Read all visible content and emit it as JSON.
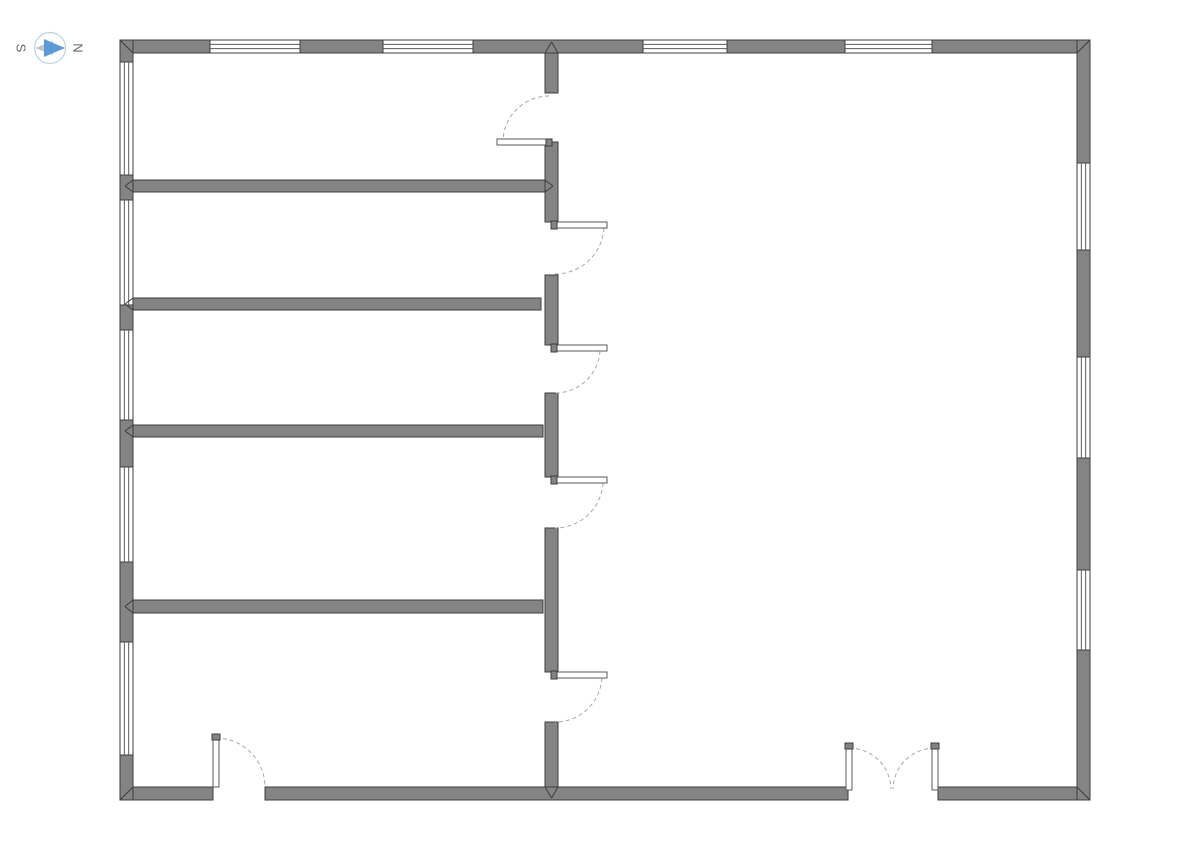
{
  "compass": {
    "south_label": "S",
    "north_label": "N",
    "circle_color": "#bcd4e6",
    "arrow_secondary_color": "#c2c6ca",
    "arrow_primary_color": "#5b9bd5",
    "label_color": "#666666"
  },
  "canvas": {
    "width": 1190,
    "height": 842,
    "background": "#ffffff"
  },
  "style": {
    "wall_fill": "#848484",
    "wall_stroke": "#3d3d3d",
    "window_fill": "#ffffff",
    "window_line_color": "#5a5a5a",
    "door_leaf_fill": "#ffffff",
    "door_leaf_stroke": "#5a5a5a",
    "door_arc_color": "#a8a8a8"
  },
  "walls": [
    {
      "name": "top-wall-segment",
      "x": 120,
      "y": 40,
      "w": 90,
      "h": 13
    },
    {
      "name": "top-wall-segment",
      "x": 300,
      "y": 40,
      "w": 83,
      "h": 13
    },
    {
      "name": "top-wall-segment",
      "x": 473,
      "y": 40,
      "w": 170,
      "h": 13
    },
    {
      "name": "top-wall-segment",
      "x": 727,
      "y": 40,
      "w": 118,
      "h": 13
    },
    {
      "name": "top-wall-segment",
      "x": 932,
      "y": 40,
      "w": 158,
      "h": 13
    },
    {
      "name": "bottom-wall-segment",
      "x": 120,
      "y": 787,
      "w": 93,
      "h": 13
    },
    {
      "name": "bottom-wall-segment",
      "x": 265,
      "y": 787,
      "w": 583,
      "h": 13
    },
    {
      "name": "bottom-wall-segment",
      "x": 938,
      "y": 787,
      "w": 152,
      "h": 13
    },
    {
      "name": "left-wall-segment",
      "x": 120,
      "y": 40,
      "w": 13,
      "h": 22
    },
    {
      "name": "left-wall-segment",
      "x": 120,
      "y": 175,
      "w": 13,
      "h": 25
    },
    {
      "name": "left-wall-segment",
      "x": 120,
      "y": 305,
      "w": 13,
      "h": 25
    },
    {
      "name": "left-wall-segment",
      "x": 120,
      "y": 420,
      "w": 13,
      "h": 47
    },
    {
      "name": "left-wall-segment",
      "x": 120,
      "y": 562,
      "w": 13,
      "h": 80
    },
    {
      "name": "left-wall-segment",
      "x": 120,
      "y": 755,
      "w": 13,
      "h": 45
    },
    {
      "name": "right-wall-segment",
      "x": 1077,
      "y": 40,
      "w": 13,
      "h": 123
    },
    {
      "name": "right-wall-segment",
      "x": 1077,
      "y": 250,
      "w": 13,
      "h": 107
    },
    {
      "name": "right-wall-segment",
      "x": 1077,
      "y": 458,
      "w": 13,
      "h": 112
    },
    {
      "name": "right-wall-segment",
      "x": 1077,
      "y": 650,
      "w": 13,
      "h": 150
    },
    {
      "name": "middle-wall-segment",
      "x": 545,
      "y": 53,
      "w": 13,
      "h": 40
    },
    {
      "name": "middle-wall-segment",
      "x": 545,
      "y": 142,
      "w": 13,
      "h": 80
    },
    {
      "name": "middle-wall-segment",
      "x": 545,
      "y": 275,
      "w": 13,
      "h": 70
    },
    {
      "name": "middle-wall-segment",
      "x": 545,
      "y": 393,
      "w": 13,
      "h": 84
    },
    {
      "name": "middle-wall-segment",
      "x": 545,
      "y": 528,
      "w": 13,
      "h": 144
    },
    {
      "name": "middle-wall-segment",
      "x": 545,
      "y": 722,
      "w": 13,
      "h": 65
    },
    {
      "name": "interior-wall-1",
      "x": 133,
      "y": 180,
      "w": 412,
      "h": 12
    },
    {
      "name": "interior-wall-2",
      "x": 133,
      "y": 298,
      "w": 408,
      "h": 12
    },
    {
      "name": "interior-wall-3",
      "x": 133,
      "y": 425,
      "w": 410,
      "h": 12
    },
    {
      "name": "interior-wall-4",
      "x": 133,
      "y": 600,
      "w": 410,
      "h": 13
    }
  ],
  "windows": [
    {
      "name": "window-top-1",
      "x": 210,
      "y": 40,
      "w": 90,
      "h": 13,
      "o": "h"
    },
    {
      "name": "window-top-2",
      "x": 383,
      "y": 40,
      "w": 90,
      "h": 13,
      "o": "h"
    },
    {
      "name": "window-top-3",
      "x": 643,
      "y": 40,
      "w": 84,
      "h": 13,
      "o": "h"
    },
    {
      "name": "window-top-4",
      "x": 845,
      "y": 40,
      "w": 87,
      "h": 13,
      "o": "h"
    },
    {
      "name": "window-left-1",
      "x": 120,
      "y": 62,
      "w": 13,
      "h": 113,
      "o": "v"
    },
    {
      "name": "window-left-2",
      "x": 120,
      "y": 200,
      "w": 13,
      "h": 105,
      "o": "v"
    },
    {
      "name": "window-left-3",
      "x": 120,
      "y": 330,
      "w": 13,
      "h": 90,
      "o": "v"
    },
    {
      "name": "window-left-4",
      "x": 120,
      "y": 467,
      "w": 13,
      "h": 95,
      "o": "v"
    },
    {
      "name": "window-left-5",
      "x": 120,
      "y": 642,
      "w": 13,
      "h": 113,
      "o": "v"
    },
    {
      "name": "window-right-1",
      "x": 1077,
      "y": 163,
      "w": 13,
      "h": 87,
      "o": "v"
    },
    {
      "name": "window-right-2",
      "x": 1077,
      "y": 357,
      "w": 13,
      "h": 101,
      "o": "v"
    },
    {
      "name": "window-right-3",
      "x": 1077,
      "y": 570,
      "w": 13,
      "h": 80,
      "o": "v"
    }
  ],
  "doors": [
    {
      "name": "door-room1",
      "leaf": [
        497,
        139,
        55,
        6
      ],
      "cap": [
        546,
        139,
        6,
        7
      ],
      "arc": "M549,96 A46,46 0 0 0 503,142"
    },
    {
      "name": "door-room2",
      "leaf": [
        552,
        222,
        55,
        6
      ],
      "cap": [
        551,
        221,
        6,
        8
      ],
      "arc": "M604,228 A49,49 0 0 1 555,274"
    },
    {
      "name": "door-room3",
      "leaf": [
        552,
        345,
        55,
        6
      ],
      "cap": [
        551,
        344,
        6,
        8
      ],
      "arc": "M600,351 A45,45 0 0 1 555,393"
    },
    {
      "name": "door-room4",
      "leaf": [
        552,
        477,
        55,
        6
      ],
      "cap": [
        551,
        476,
        6,
        8
      ],
      "arc": "M603,483 A48,48 0 0 1 555,528"
    },
    {
      "name": "door-room5",
      "leaf": [
        552,
        672,
        55,
        6
      ],
      "cap": [
        551,
        671,
        6,
        8
      ],
      "arc": "M602,678 A47,47 0 0 1 555,722"
    },
    {
      "name": "door-exterior-left",
      "leaf": [
        213,
        735,
        6,
        52
      ],
      "cap": [
        212,
        734,
        8,
        6
      ],
      "arc": "M216,738 A49,49 0 0 1 265,787"
    },
    {
      "name": "double-door-left-leaf",
      "leaf": [
        846,
        745,
        6,
        45
      ],
      "cap": [
        845,
        743,
        8,
        6
      ],
      "arc": "M849,748 A42,42 0 0 1 891,789"
    },
    {
      "name": "double-door-right-leaf",
      "leaf": [
        932,
        745,
        6,
        45
      ],
      "cap": [
        931,
        743,
        8,
        6
      ],
      "arc": "M935,748 A42,42 0 0 0 893,789"
    }
  ],
  "miters": [
    {
      "name": "miter-corner-top-left",
      "d": "M120,40 L133,53"
    },
    {
      "name": "miter-corner-top-right",
      "d": "M1090,40 L1077,53"
    },
    {
      "name": "miter-corner-bottom-left",
      "d": "M120,800 L133,787"
    },
    {
      "name": "miter-corner-bottom-right",
      "d": "M1090,800 L1077,787"
    },
    {
      "name": "miter-top-middle-junction",
      "d": "M545,53 L551.5,42 M558,53 L551.5,42"
    },
    {
      "name": "miter-bottom-middle-junction",
      "d": "M545,787 L551.5,798 M558,787 L551.5,798"
    },
    {
      "name": "miter-left-wall1-junction",
      "d": "M133,180 L125,186 M133,192 L125,186"
    },
    {
      "name": "miter-left-wall2-junction",
      "d": "M133,298 L125,304 M133,310 L125,304"
    },
    {
      "name": "miter-left-wall3-junction",
      "d": "M133,425 L125,431 M133,437 L125,431"
    },
    {
      "name": "miter-left-wall4-junction",
      "d": "M133,600 L125,606.5 M133,613 L125,606.5"
    },
    {
      "name": "miter-wall1-middle-junction",
      "d": "M545,180 L553,186 M545,192 L553,186"
    }
  ]
}
